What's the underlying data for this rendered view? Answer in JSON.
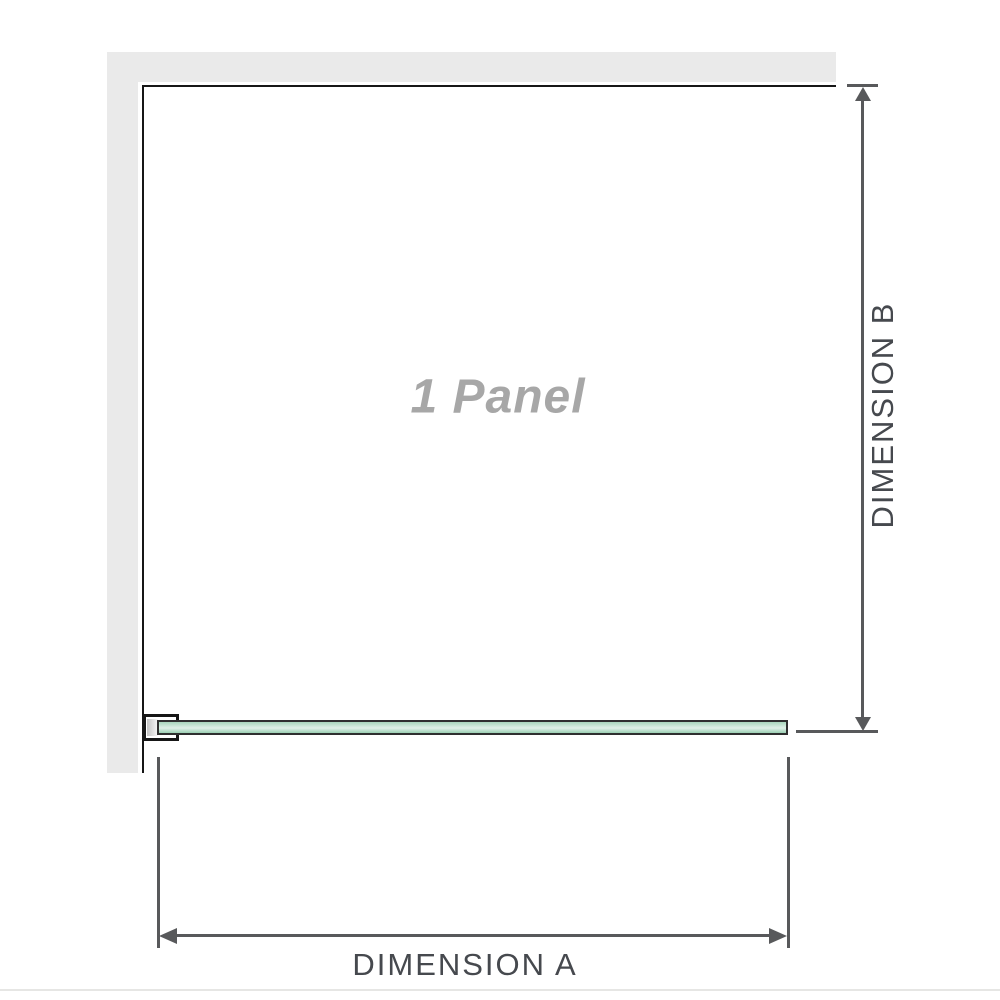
{
  "diagram": {
    "panel_label": "1 Panel",
    "dimensions": {
      "a_label": "DIMENSION A",
      "b_label": "DIMENSION B"
    },
    "colors": {
      "wall_fill": "#eaeaea",
      "wall_edge": "#161616",
      "glass_top": "#a8d6bc",
      "glass_mid": "#e0f1e8",
      "glass_bottom": "#9bcfb3",
      "glass_outline": "#2f2f2f",
      "dimension_line": "#58595b",
      "label_dark": "#46494e",
      "label_muted": "#a7a7a7",
      "baseline_rule": "#e6e6e4",
      "bracket_shim_dark": "#c3c3c3",
      "bracket_shim_light": "#f8f8f8"
    }
  }
}
